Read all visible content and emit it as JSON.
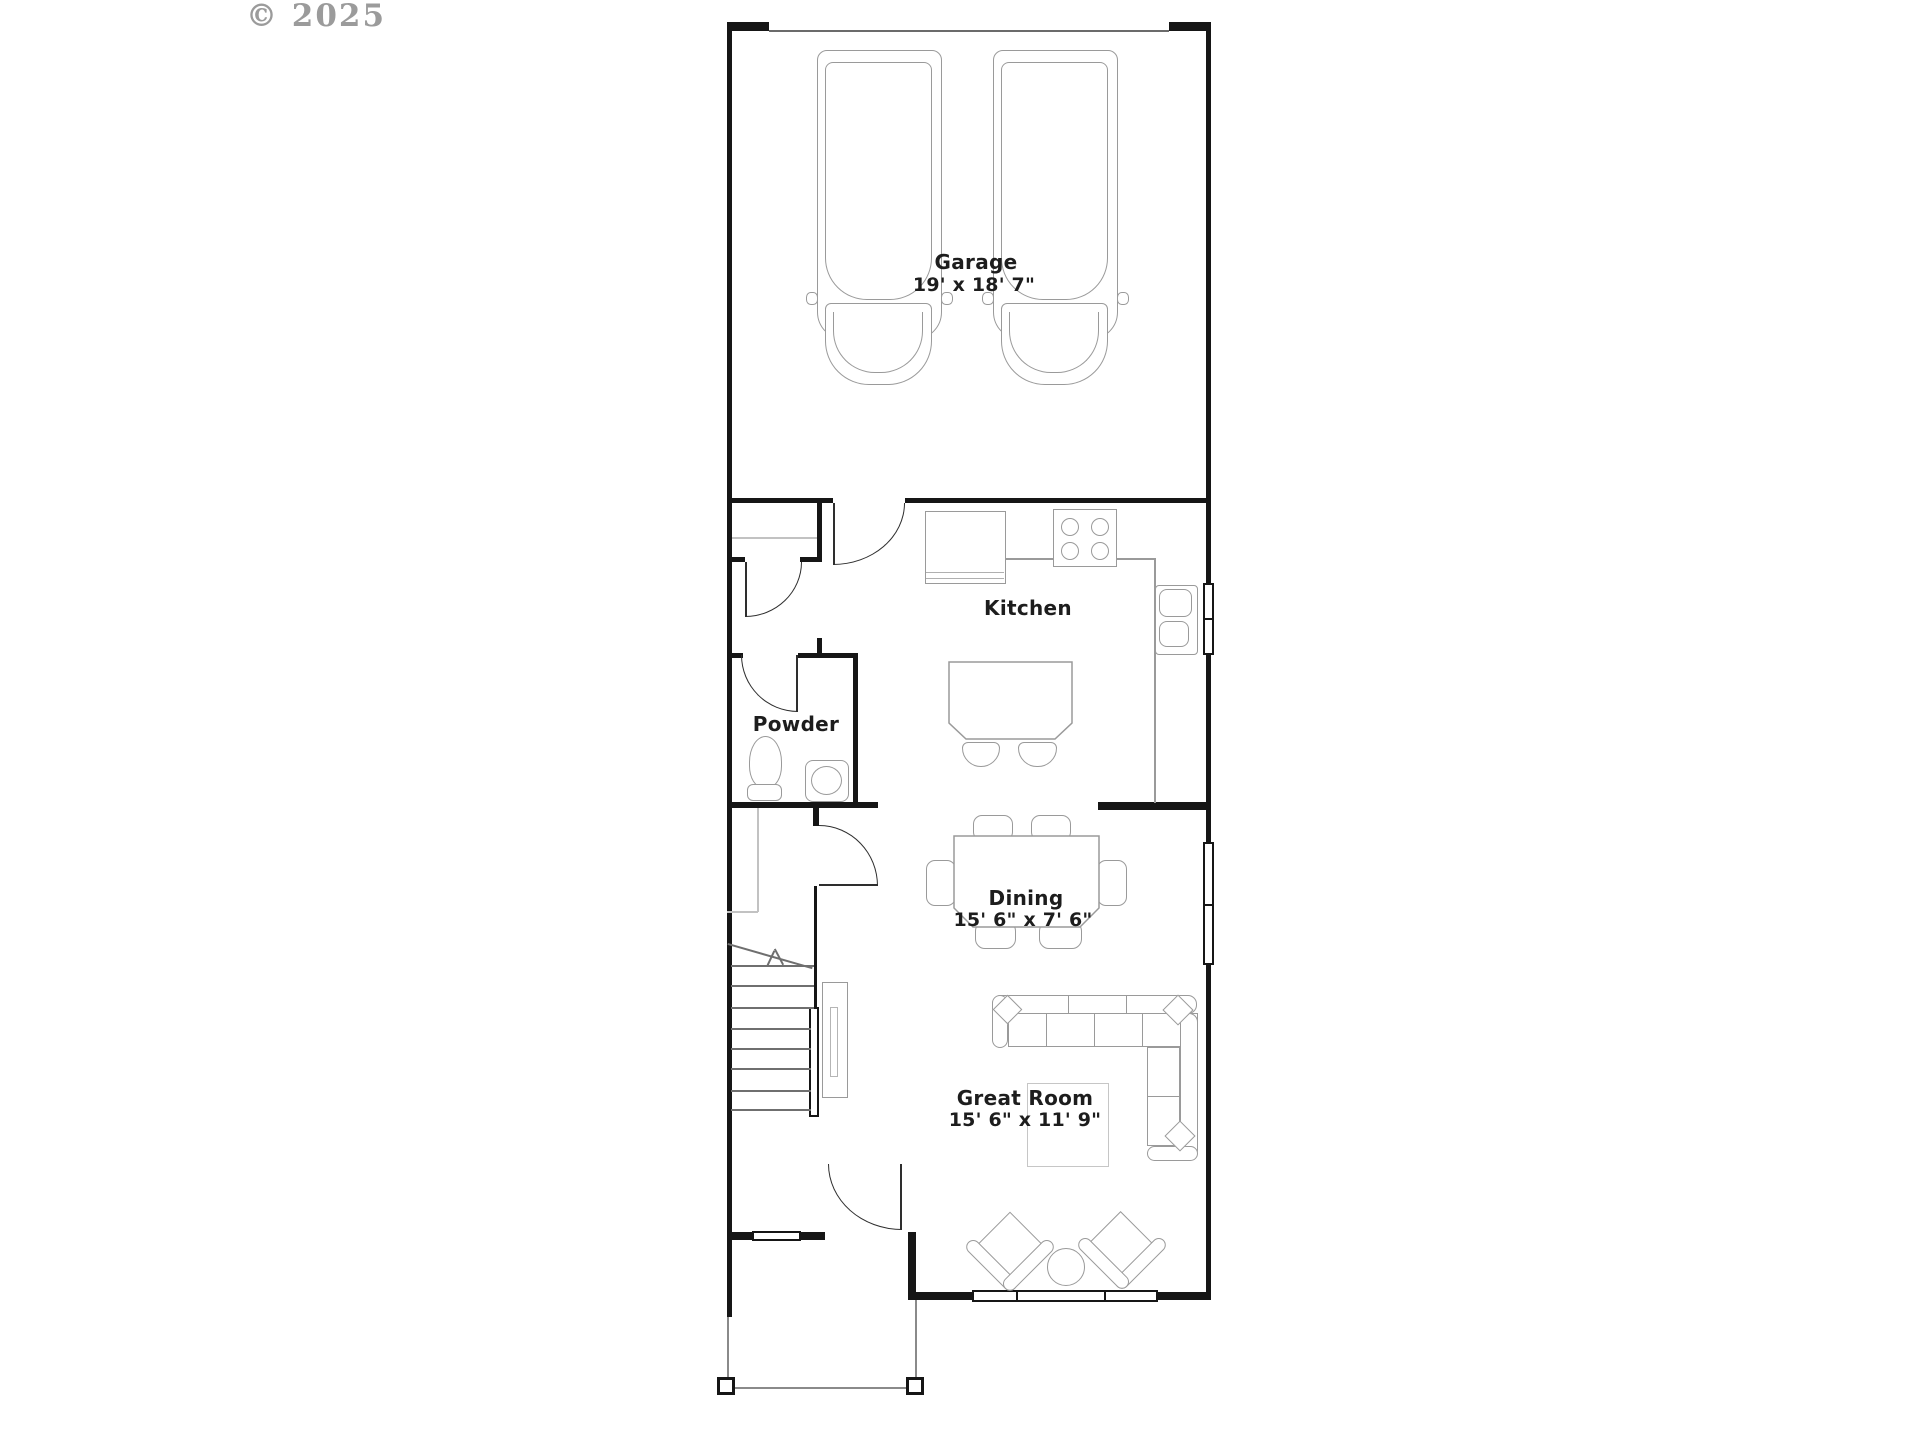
{
  "copyright": "© 2025",
  "rooms": {
    "garage": {
      "label": "Garage",
      "dims": "19' x 18' 7\""
    },
    "kitchen": {
      "label": "Kitchen"
    },
    "powder": {
      "label": "Powder"
    },
    "dining": {
      "label": "Dining",
      "dims": "15' 6\" x 7' 6\""
    },
    "great_room": {
      "label": "Great Room",
      "dims": "15' 6\" x 11' 9\""
    }
  },
  "colors": {
    "wall": "#161616",
    "furniture": "#9a9a9a",
    "text": "#1d1d1d",
    "copyright": "#8a8a8a"
  }
}
